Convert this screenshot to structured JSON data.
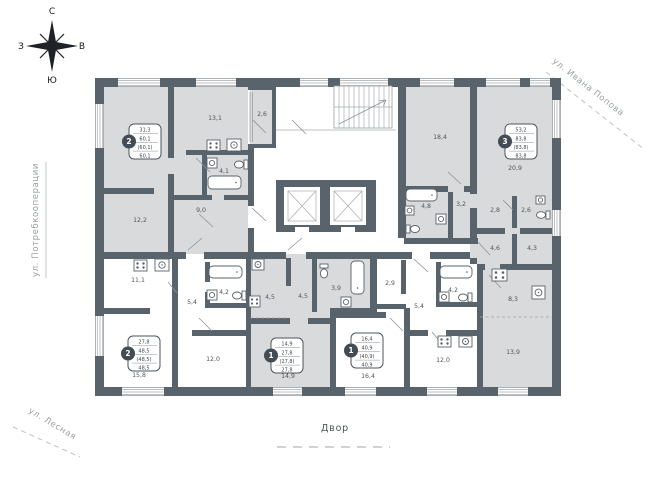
{
  "palette": {
    "wall": "#59636b",
    "apartment_fill": "#d9dadb",
    "floor": "#ffffff",
    "room_label": "#4f575e",
    "street_label": "#9aa0a5",
    "badge_circle": "#434c54"
  },
  "compass": {
    "north": "С",
    "south": "Ю",
    "west": "З",
    "east": "В"
  },
  "streets": {
    "top_right": "ул. Ивана Попова",
    "left": "ул. Потребкооперации",
    "bottom_left": "ул. Лесная"
  },
  "courtyard_label": "Двор",
  "icons": {
    "compass": "compass-rose-icon",
    "stairs": "stairs-icon",
    "elevator": "elevator-shaft-icon",
    "stove": "stove-icon",
    "sink": "sink-icon",
    "bathtub": "bathtub-icon",
    "toilet": "toilet-icon",
    "washer": "washing-machine-icon"
  },
  "apartments": [
    {
      "badge": "2",
      "living": "31,3",
      "area": "60,1",
      "area_with_coef": "(60,1)",
      "total": "60,1"
    },
    {
      "badge": "3",
      "living": "53,2",
      "area": "83,8",
      "area_with_coef": "(83,8)",
      "total": "83,8"
    },
    {
      "badge": "2",
      "living": "27,8",
      "area": "48,5",
      "area_with_coef": "(48,5)",
      "total": "48,5"
    },
    {
      "badge": "1",
      "living": "14,9",
      "area": "27,8",
      "area_with_coef": "(27,8)",
      "total": "27,8"
    },
    {
      "badge": "1",
      "living": "16,4",
      "area": "40,9",
      "area_with_coef": "(40,9)",
      "total": "40,9"
    }
  ],
  "rooms": [
    {
      "label": "19,1"
    },
    {
      "label": "12,2"
    },
    {
      "label": "13,1"
    },
    {
      "label": "4,1"
    },
    {
      "label": "9,0"
    },
    {
      "label": "2,6"
    },
    {
      "label": "18,4"
    },
    {
      "label": "20,9"
    },
    {
      "label": "4,8"
    },
    {
      "label": "3,2"
    },
    {
      "label": "2,8"
    },
    {
      "label": "2,6"
    },
    {
      "label": "4,6"
    },
    {
      "label": "4,3"
    },
    {
      "label": "8,3"
    },
    {
      "label": "13,9"
    },
    {
      "label": "11,1"
    },
    {
      "label": "5,4"
    },
    {
      "label": "4,2"
    },
    {
      "label": "15,8"
    },
    {
      "label": "12,0"
    },
    {
      "label": "4,5"
    },
    {
      "label": "4,5"
    },
    {
      "label": "3,9"
    },
    {
      "label": "14,9"
    },
    {
      "label": "16,4"
    },
    {
      "label": "2,9"
    },
    {
      "label": "5,4"
    },
    {
      "label": "4,2"
    },
    {
      "label": "12,0"
    }
  ]
}
